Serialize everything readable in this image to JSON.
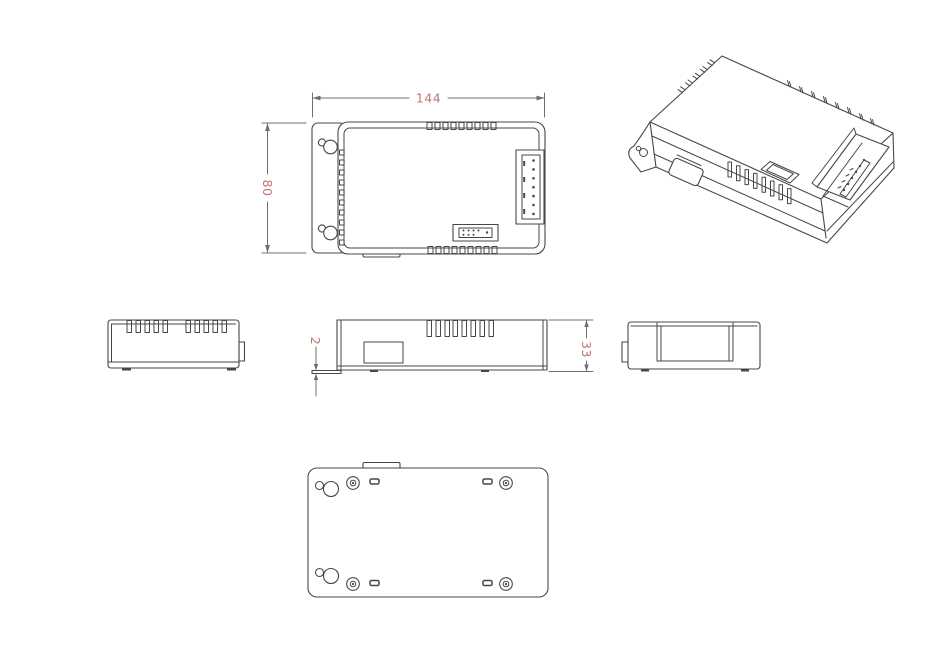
{
  "drawing": {
    "title": "enclosure-orthographic-views",
    "dimensions": {
      "overall_width": "144",
      "overall_height": "80",
      "flange_thickness": "2",
      "body_depth": "33"
    },
    "colors": {
      "line": "#474747",
      "dimension_line": "#6f6f6f",
      "dimension_text": "#bf7672",
      "background": "#ffffff"
    }
  }
}
